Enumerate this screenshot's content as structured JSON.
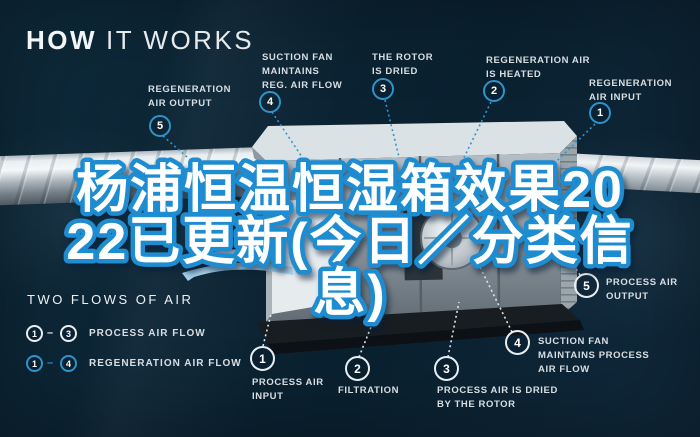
{
  "title": {
    "bold": "HOW",
    "light": "IT WORKS"
  },
  "overlay": {
    "full_text": "杨浦恒温恒湿箱效果2022已更新(今日／分类信息)",
    "lines": [
      "杨浦恒温恒湿箱效果20",
      "22已更新(今日／分类信",
      "息)"
    ]
  },
  "top_callouts": [
    {
      "num": "5",
      "label": "REGENERATION\nAIR OUTPUT"
    },
    {
      "num": "4",
      "label": "SUCTION FAN\nMAINTAINS\nREG. AIR FLOW"
    },
    {
      "num": "3",
      "label": "THE ROTOR\nIS DRIED"
    },
    {
      "num": "2",
      "label": "REGENERATION AIR\nIS HEATED"
    },
    {
      "num": "1",
      "label": "REGENERATION\nAIR INPUT"
    }
  ],
  "bottom_callouts": [
    {
      "num": "1",
      "label": "PROCESS AIR\nINPUT"
    },
    {
      "num": "2",
      "label": "FILTRATION"
    },
    {
      "num": "3",
      "label": "PROCESS AIR IS DRIED\nBY THE ROTOR"
    },
    {
      "num": "4",
      "label": "SUCTION FAN\nMAINTAINS PROCESS\nAIR FLOW"
    },
    {
      "num": "5",
      "label": "PROCESS AIR\nOUTPUT"
    }
  ],
  "legend": {
    "heading": "TWO FLOWS OF AIR",
    "rows": [
      {
        "from": "1",
        "separator": "–",
        "to": "3",
        "label": "PROCESS AIR FLOW",
        "circle_style": "white"
      },
      {
        "from": "1",
        "separator": "–",
        "to": "4",
        "label": "REGENERATION AIR FLOW",
        "circle_style": "blue"
      }
    ]
  },
  "colors": {
    "background": "#0c2434",
    "accent_blue": "#2e93c8",
    "overlay_stroke_blue": "#1e8cd0",
    "label_text": "#d8dee2",
    "title_text": "#f1f5f7"
  }
}
